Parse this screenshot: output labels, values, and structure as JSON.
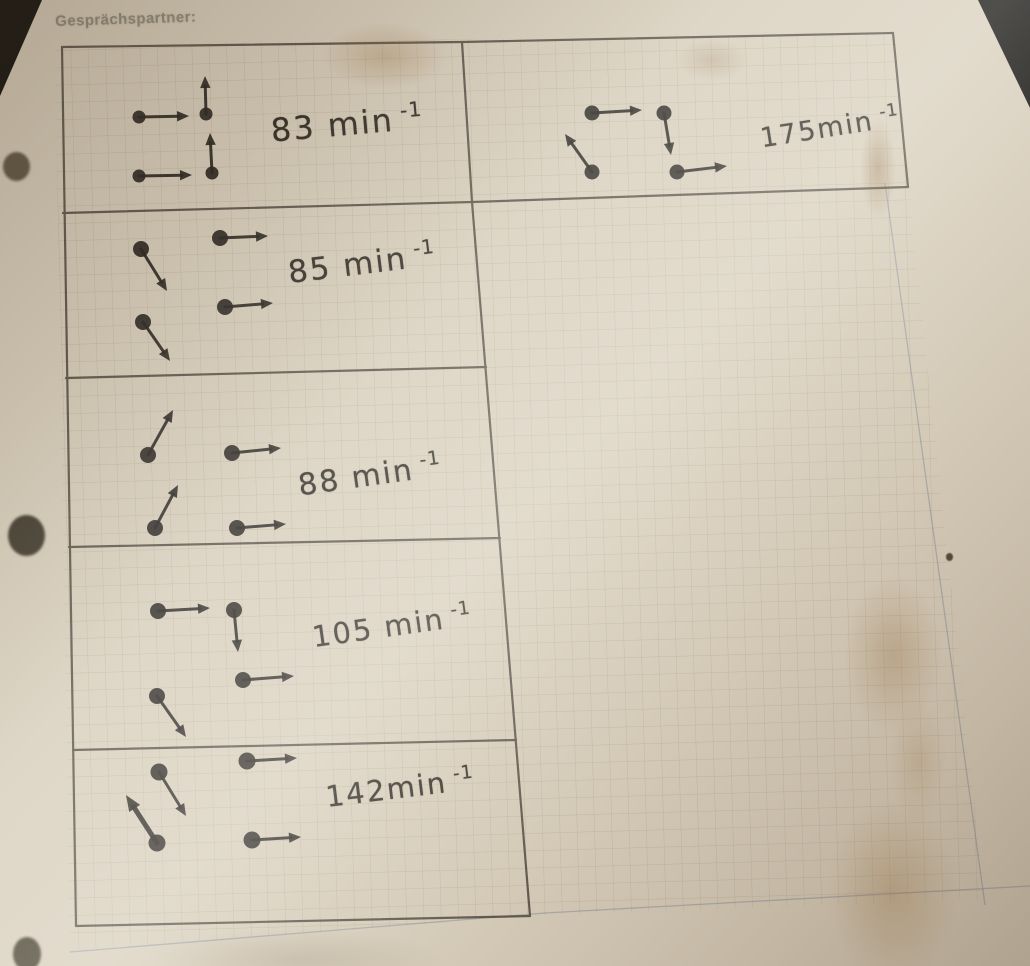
{
  "photo": {
    "header_label": "Gesprächspartner:",
    "hole_punch_count": 3
  },
  "colors": {
    "paper": "#d8cfbe",
    "pencil_line": "#4a443c",
    "ink": "#23201d",
    "printed_text": "#8e8779",
    "margin_line": "#7d87a0"
  },
  "table": {
    "unit": "min⁻¹",
    "borders": [
      [
        62,
        47,
        462,
        42
      ],
      [
        462,
        42,
        893,
        33
      ],
      [
        63,
        213,
        472,
        202
      ],
      [
        472,
        202,
        908,
        187
      ],
      [
        66,
        378,
        486,
        367
      ],
      [
        69,
        547,
        500,
        538
      ],
      [
        73,
        750,
        516,
        740
      ],
      [
        76,
        926,
        530,
        916
      ],
      [
        62,
        47,
        76,
        926
      ],
      [
        462,
        42,
        472,
        202
      ],
      [
        472,
        202,
        530,
        916
      ],
      [
        893,
        33,
        908,
        187
      ]
    ],
    "margin_lines": [
      "885,183 985,905",
      "70,952 545,913 1030,886"
    ],
    "cells": [
      {
        "id": "83",
        "value": 83,
        "label": "83 min",
        "sup": "-1",
        "label_pos": {
          "x": 347,
          "y": 124,
          "rot": -5,
          "size": 32
        },
        "dot_r": 6.5,
        "vectors": [
          {
            "dot": [
              139,
              117
            ],
            "tip": [
              189,
              116
            ]
          },
          {
            "dot": [
              206,
              114
            ],
            "tip": [
              205,
              76
            ]
          },
          {
            "dot": [
              139,
              176
            ],
            "tip": [
              192,
              175
            ]
          },
          {
            "dot": [
              212,
              173
            ],
            "tip": [
              210,
              133
            ]
          }
        ]
      },
      {
        "id": "175",
        "value": 175,
        "label": "175min",
        "sup": "-1",
        "label_pos": {
          "x": 830,
          "y": 128,
          "rot": -9,
          "size": 27
        },
        "dot_r": 7.5,
        "vectors": [
          {
            "dot": [
              592,
              113
            ],
            "tip": [
              642,
              110
            ]
          },
          {
            "dot": [
              664,
              113
            ],
            "tip": [
              671,
              155
            ]
          },
          {
            "dot": [
              592,
              172
            ],
            "tip": [
              565,
              134
            ]
          },
          {
            "dot": [
              677,
              172
            ],
            "tip": [
              727,
              166
            ]
          }
        ]
      },
      {
        "id": "85",
        "value": 85,
        "label": "85 min",
        "sup": "-1",
        "label_pos": {
          "x": 362,
          "y": 264,
          "rot": -7,
          "size": 31
        },
        "dot_r": 8,
        "vectors": [
          {
            "dot": [
              141,
              249
            ],
            "tip": [
              167,
              291
            ]
          },
          {
            "dot": [
              220,
              238
            ],
            "tip": [
              268,
              236
            ]
          },
          {
            "dot": [
              143,
              322
            ],
            "tip": [
              170,
              361
            ]
          },
          {
            "dot": [
              225,
              307
            ],
            "tip": [
              273,
              303
            ]
          }
        ]
      },
      {
        "id": "88",
        "value": 88,
        "label": "88 min",
        "sup": "-1",
        "label_pos": {
          "x": 370,
          "y": 476,
          "rot": -8,
          "size": 30
        },
        "dot_r": 8,
        "vectors": [
          {
            "dot": [
              148,
              455
            ],
            "tip": [
              173,
              410
            ]
          },
          {
            "dot": [
              232,
              453
            ],
            "tip": [
              281,
              448
            ]
          },
          {
            "dot": [
              155,
              528
            ],
            "tip": [
              178,
              485
            ]
          },
          {
            "dot": [
              237,
              528
            ],
            "tip": [
              286,
              524
            ]
          }
        ]
      },
      {
        "id": "105",
        "value": 105,
        "label": "105 min",
        "sup": "-1",
        "label_pos": {
          "x": 392,
          "y": 626,
          "rot": -8,
          "size": 29
        },
        "dot_r": 8,
        "vectors": [
          {
            "dot": [
              158,
              611
            ],
            "tip": [
              210,
              608
            ]
          },
          {
            "dot": [
              234,
              610
            ],
            "tip": [
              238,
              652
            ]
          },
          {
            "dot": [
              243,
              680
            ],
            "tip": [
              294,
              676
            ]
          },
          {
            "dot": [
              157,
              696
            ],
            "tip": [
              186,
              737
            ]
          }
        ]
      },
      {
        "id": "142",
        "value": 142,
        "label": "142min",
        "sup": "-1",
        "label_pos": {
          "x": 400,
          "y": 788,
          "rot": -7,
          "size": 29
        },
        "dot_r": 8.5,
        "vectors": [
          {
            "dot": [
              159,
              772
            ],
            "tip": [
              186,
              816
            ]
          },
          {
            "dot": [
              247,
              761
            ],
            "tip": [
              297,
              758
            ]
          },
          {
            "dot": [
              157,
              843
            ],
            "tip": [
              126,
              795
            ],
            "w": 5
          },
          {
            "dot": [
              252,
              840
            ],
            "tip": [
              301,
              837
            ]
          }
        ]
      }
    ]
  }
}
